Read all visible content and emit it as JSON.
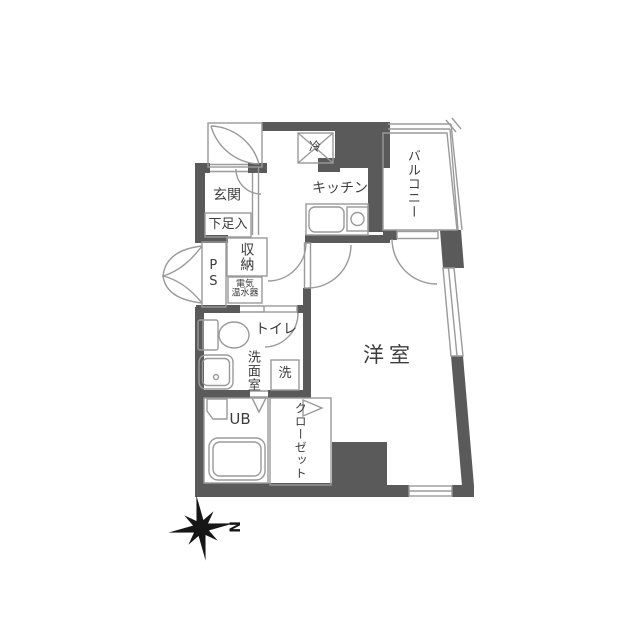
{
  "floorplan": {
    "rooms": {
      "entrance": {
        "label": "玄関"
      },
      "shoe_box": {
        "label": "下足入"
      },
      "storage": {
        "label": "収納"
      },
      "pipe_space": {
        "label": "PS"
      },
      "water_heater": {
        "line1": "電気",
        "line2": "温水器"
      },
      "kitchen": {
        "label": "キッチン"
      },
      "refrigerator": {
        "label": "冷"
      },
      "balcony": {
        "label": "バルコニー"
      },
      "western_room": {
        "label": "洋室"
      },
      "toilet": {
        "label": "トイレ"
      },
      "washroom": {
        "label": "洗面室"
      },
      "washer": {
        "label": "洗"
      },
      "unit_bath": {
        "label": "UB"
      },
      "closet": {
        "label": "クローゼット"
      }
    },
    "compass": {
      "north_label": "N"
    },
    "colors": {
      "wall": "#5a5a5a",
      "thin_line": "#9a9a9a",
      "text": "#3c3c3c",
      "compass": "#161616",
      "background": "#ffffff"
    }
  }
}
